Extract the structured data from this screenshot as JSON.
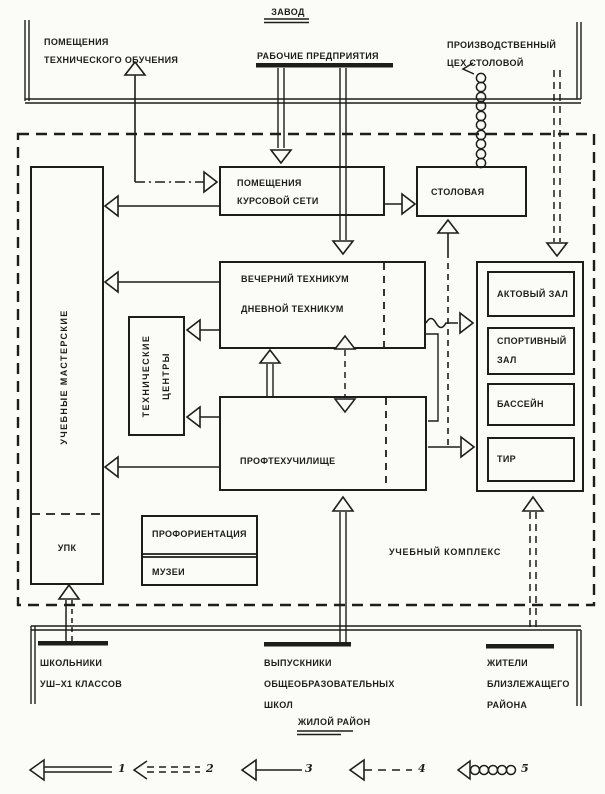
{
  "palette": {
    "ink": "#1d1d1b",
    "paper": "#fbfbf7"
  },
  "factory": {
    "label": "ЗАВОД"
  },
  "district": {
    "label": "ЖИЛОЙ РАЙОН"
  },
  "external_top": {
    "tech_training": [
      "ПОМЕЩЕНИЯ",
      "ТЕХНИЧЕСКОГО ОБУЧЕНИЯ"
    ],
    "workers": "РАБОЧИЕ ПРЕДПРИЯТИЯ",
    "canteen_shop": [
      "ПРОИЗВОДСТВЕННЫЙ",
      "ЦЕХ СТОЛОВОЙ"
    ]
  },
  "external_bottom": {
    "schoolkids": [
      "ШКОЛЬНИКИ",
      "УШ–Х1 КЛАССОВ"
    ],
    "graduates": [
      "ВЫПУСКНИКИ",
      "ОБЩЕОБРАЗОВАТЕЛЬНЫХ",
      "ШКОЛ"
    ],
    "residents": [
      "ЖИТЕЛИ",
      "БЛИЗЛЕЖАЩЕГО",
      "РАЙОНА"
    ]
  },
  "complex": {
    "label": "УЧЕБНЫЙ КОМПЛЕКС",
    "workshops": "УЧЕБНЫЕ МАСТЕРСКИЕ",
    "upk": "УПК",
    "course_rooms": [
      "ПОМЕЩЕНИЯ",
      "КУРСОВОЙ СЕТИ"
    ],
    "canteen": "СТОЛОВАЯ",
    "evening_technikum": "ВЕЧЕРНИЙ ТЕХНИКУМ",
    "day_technikum": "ДНЕВНОЙ ТЕХНИКУМ",
    "tech_centers": [
      "ТЕХНИЧЕСКИЕ",
      "ЦЕНТРЫ"
    ],
    "vocational_school": "ПРОФТЕХУЧИЛИЩЕ",
    "career_guidance": "ПРОФОРИЕНТАЦИЯ",
    "museums": "МУЗЕИ",
    "facilities": {
      "assembly_hall": "АКТОВЫЙ ЗАЛ",
      "sports_hall": [
        "СПОРТИВНЫЙ",
        "ЗАЛ"
      ],
      "pool": "БАССЕЙН",
      "shooting_range": "ТИР"
    }
  },
  "legend": [
    {
      "num": "1",
      "type": "double-solid-line"
    },
    {
      "num": "2",
      "type": "double-dashed-line"
    },
    {
      "num": "3",
      "type": "single-solid-line"
    },
    {
      "num": "4",
      "type": "single-dashed-line"
    },
    {
      "num": "5",
      "type": "coil-line"
    }
  ]
}
